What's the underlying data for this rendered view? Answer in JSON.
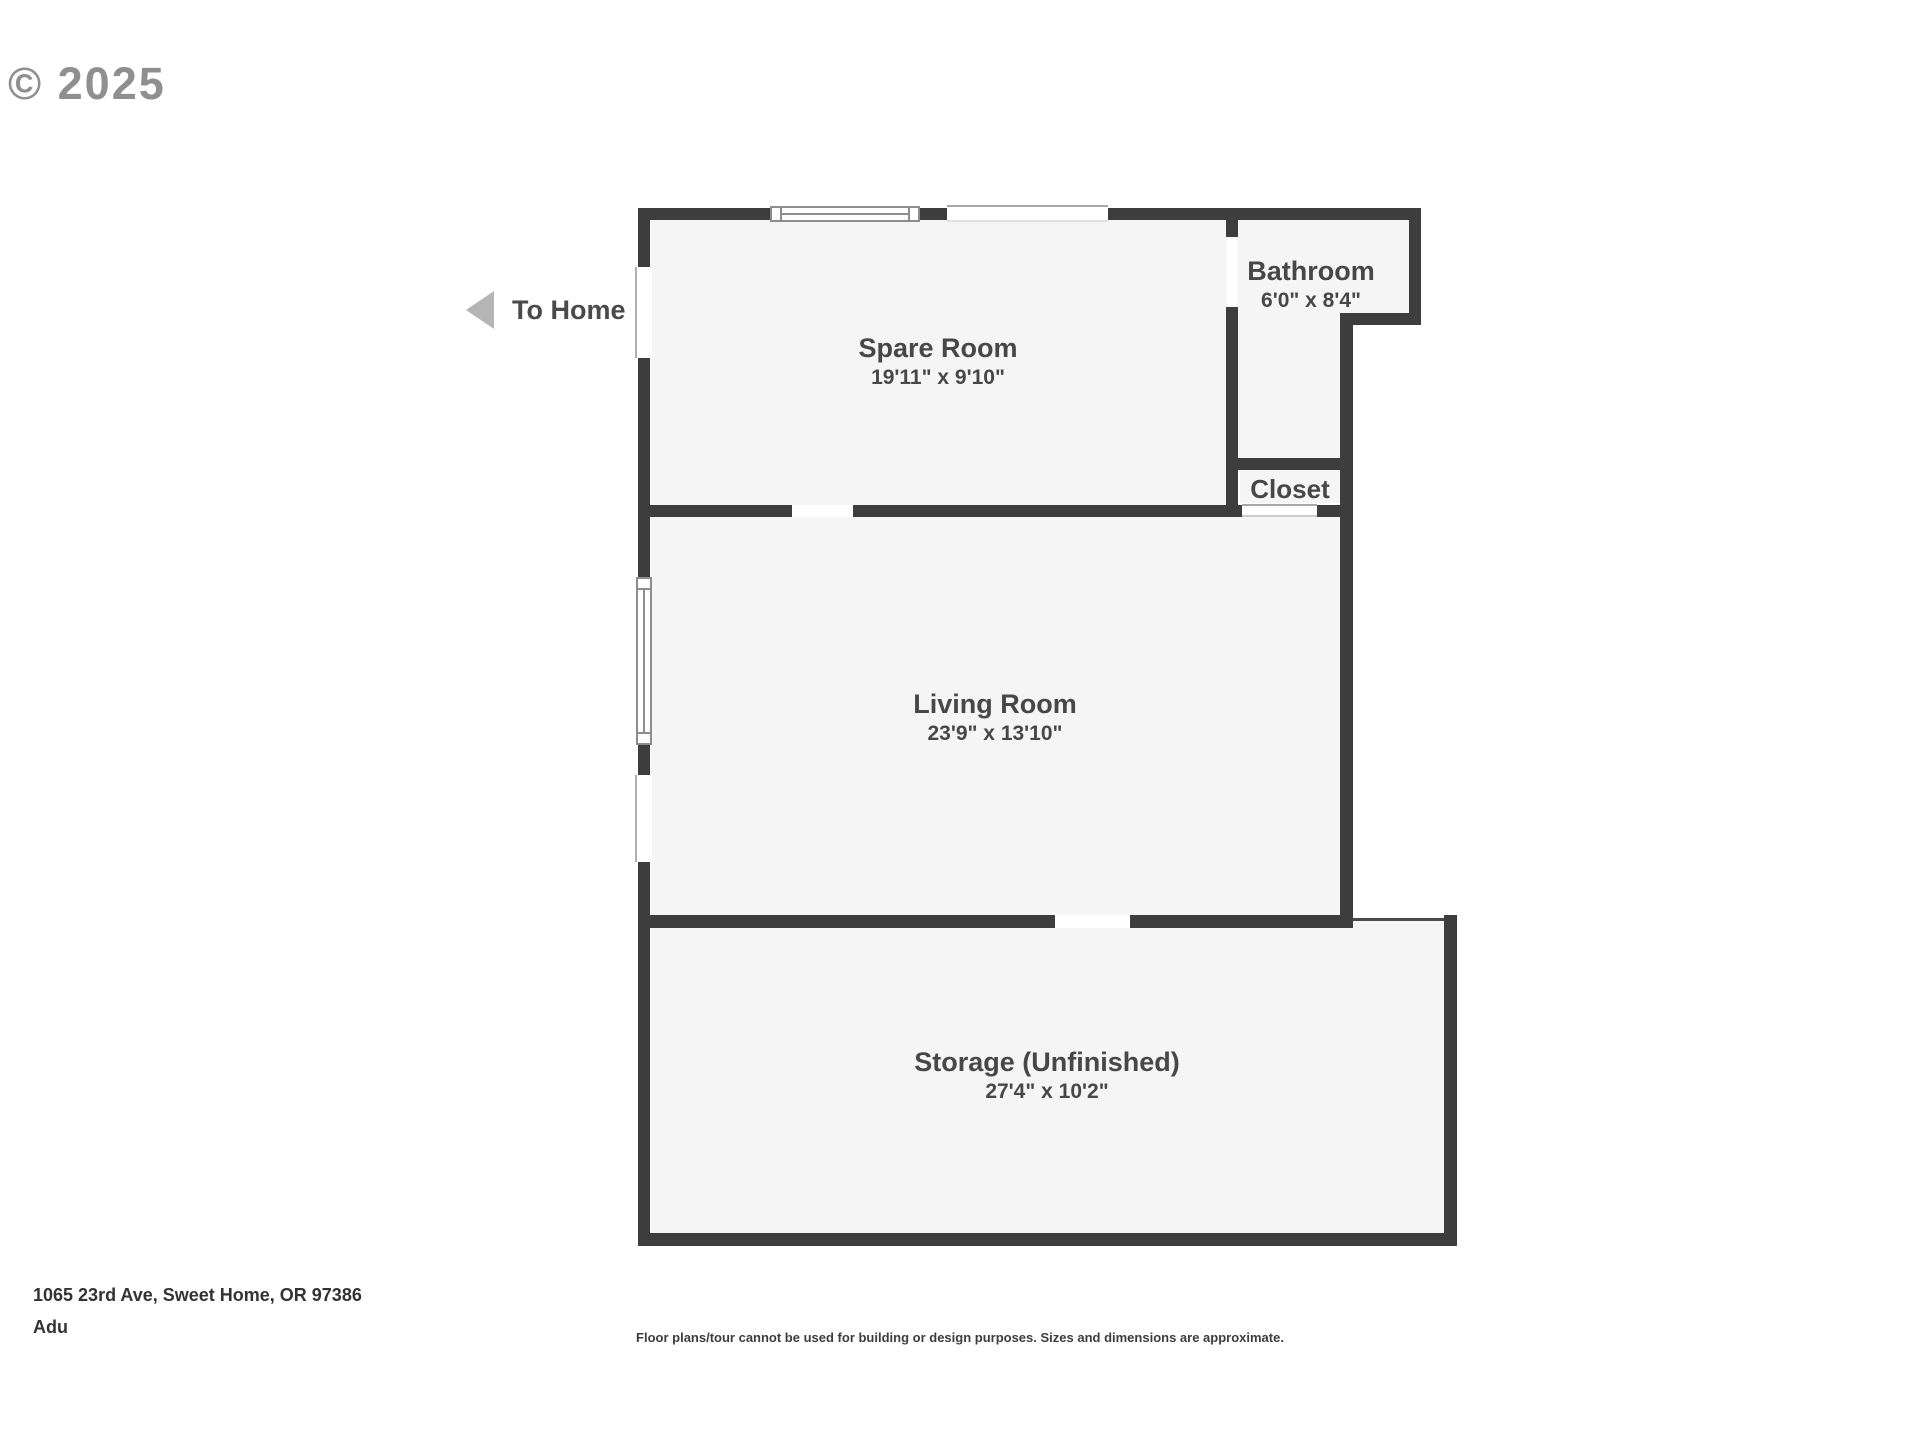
{
  "watermark": {
    "copyright": "© 2025"
  },
  "navigation": {
    "to_home_label": "To Home"
  },
  "floorplan": {
    "wall_color": "#3d3d3d",
    "room_fill_color": "#f5f5f5",
    "rooms": [
      {
        "name": "Spare Room",
        "dimensions": "19'11\" x 9'10\""
      },
      {
        "name": "Bathroom",
        "dimensions": "6'0\" x 8'4\""
      },
      {
        "name": "Closet",
        "dimensions": ""
      },
      {
        "name": "Living Room",
        "dimensions": "23'9\" x 13'10\""
      },
      {
        "name": "Storage (Unfinished)",
        "dimensions": "27'4\" x 10'2\""
      }
    ]
  },
  "footer": {
    "address": "1065 23rd Ave, Sweet Home, OR 97386",
    "unit": "Adu",
    "disclaimer": "Floor plans/tour cannot be used for building or design purposes. Sizes and dimensions are approximate."
  }
}
